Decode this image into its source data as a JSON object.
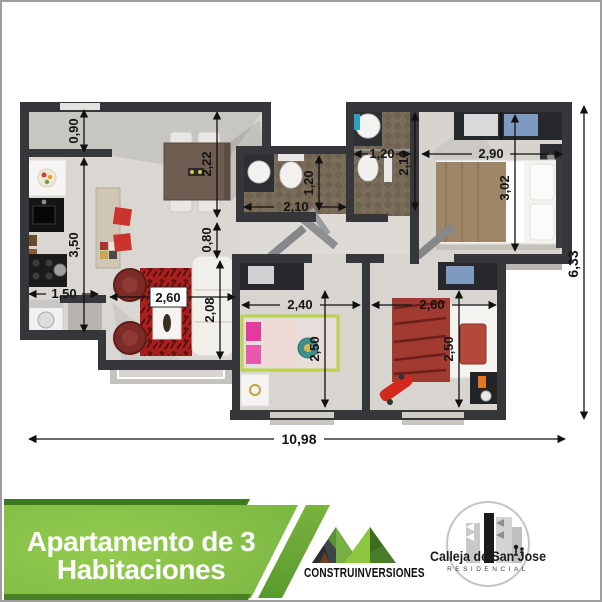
{
  "plan": {
    "dims": {
      "kitchen_pass": "0,90",
      "kitchen_len": "3,50",
      "kitchen_w": "1,50",
      "dining_len": "2,22",
      "hall_w": "0,80",
      "bath1_w": "2,10",
      "bath1_d": "1,20",
      "bath2_w": "1,20",
      "bath2_d": "2,10",
      "master_w": "2,90",
      "master_d": "3,02",
      "living_w": "2,60",
      "living_d": "2,08",
      "bed2_w": "2,40",
      "bed2_d": "2,50",
      "bed3_w": "2,60",
      "bed3_d": "2,50",
      "total_w": "10,98",
      "total_h": "6,33"
    }
  },
  "banner": {
    "title_line1": "Apartamento de 3",
    "title_line2": "Habitaciones",
    "green_light": "#8dc63f",
    "green_dark": "#549128",
    "green_stripe": "#3c7a1d"
  },
  "logos": {
    "builder_name": "CONSTRUINVERSIONES",
    "residence_name": "Calleja de San Jose",
    "residence_subtitle": "RESIDENCIAL"
  },
  "colors": {
    "wall": "#36373b",
    "floor": "#dad7d2",
    "bath_tile": "#7a6d5a",
    "rug_red": "#a81f1c",
    "sofa_white": "#f1efe9",
    "bed_cover_tan": "#9d8768",
    "accent_red": "#c9342c"
  }
}
